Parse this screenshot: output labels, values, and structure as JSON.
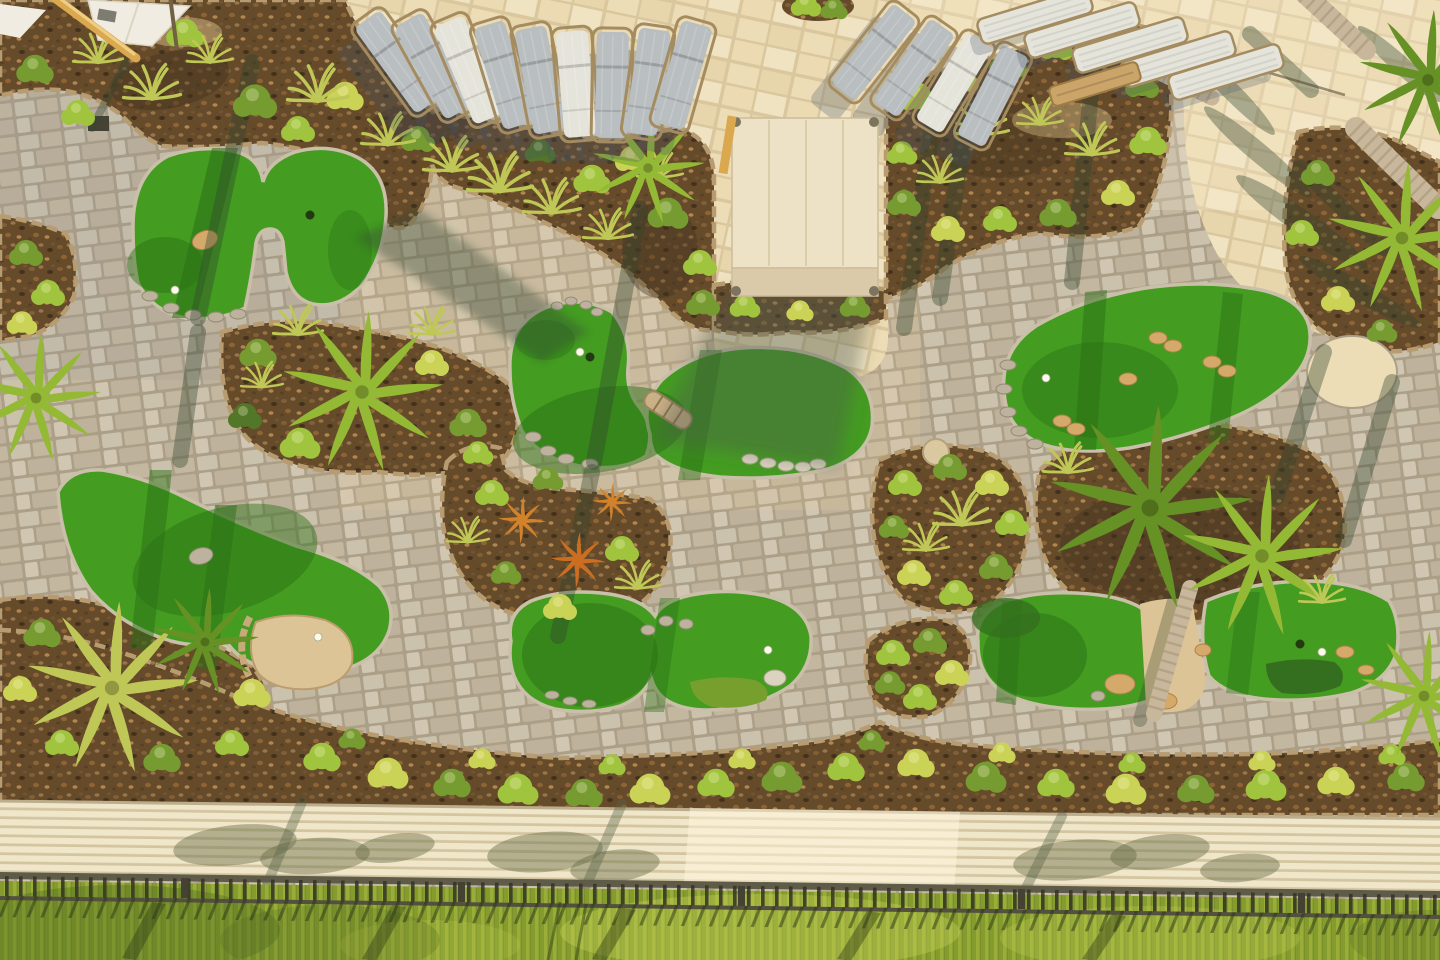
{
  "scene": {
    "type": "aerial-photograph",
    "subject": "Aerial view of an outdoor mini golf putting course with tropical landscaping at golden hour",
    "visible_text": "none"
  },
  "palette": {
    "green_sun": "#3a9a1e",
    "green_shade": "#1f6b12",
    "green_edge": "#c8c0ae",
    "fringe_dark": "#2a6b1c",
    "fringe_lime": "#6f9e2c",
    "paver_joint": "#a89d8a",
    "paver_a": "#c9c2b1",
    "paver_b": "#c1b7a4",
    "paver_c": "#cec7b7",
    "paver_d": "#bcb2a0",
    "deck_joint": "#d9c8a2",
    "deck_a": "#eddfbc",
    "deck_b": "#e6d6b0",
    "deck_c": "#ebddb7",
    "deck_d": "#f0e5c8",
    "mulch": "#5d4528",
    "bed_border": "#b59a72",
    "bush_a": "#9cc43d",
    "bush_b": "#6f9a2f",
    "bush_c": "#c9d457",
    "bush_dark": "#4a7325",
    "grass": "#bcc957",
    "frond_a": "#8fba33",
    "frond_b": "#5e8f22",
    "croton_a": "#d07f28",
    "croton_b": "#c96a1e",
    "trunk": "#c6b79e",
    "trunk_ring": "#a5957c",
    "lounger_sling": "#b6bec6",
    "lounger_light": "#e4e6e2",
    "lounger_frame": "#a08a60",
    "bench": "#c9a36a",
    "canopy": "#ece4cc",
    "canopy_fold": "#d8cbae",
    "canopy_seam": "#d9ceae",
    "pole": "#d9a84e",
    "sand": "#dbc49a",
    "rock_gray": "#b9b2a2",
    "rock_tan": "#d2a86a",
    "walk_a": "#f0e8d0",
    "walk_b": "#d2c6a5",
    "hedge_a": "#94ac36",
    "hedge_b": "#7d9a2b",
    "hedge_bright": "#ccd75a",
    "shadow": "rgba(40,62,45,0.38)"
  },
  "objects": {
    "putting_greens": [
      {
        "id": 1,
        "area": "upper-left",
        "features": "boulder obstacle, rock edging, golf ball"
      },
      {
        "id": 2,
        "area": "mid-left",
        "features": "stone block, sand patch, golf ball"
      },
      {
        "id": 3,
        "area": "center",
        "features": "log obstacle, rock clusters, golf ball and cup"
      },
      {
        "id": 4,
        "area": "mid-right",
        "features": "tan rock piles, rock edging, golf ball"
      },
      {
        "id": 5,
        "area": "lower-center",
        "features": "boulder, lime fringe patch, golf ball"
      },
      {
        "id": 6,
        "area": "lower-right",
        "features": "palm trunk through green, boulders, dark fringe, golf ball and cup"
      }
    ],
    "lounge_chairs": {
      "upper_center_fan_row": 9,
      "upper_right_diagonal_row": 4,
      "top_right_flat_row": 5,
      "wood_bench": 1
    },
    "cabana": {
      "position": "top center-right",
      "fabric": "cream canvas with seams and corner posts"
    },
    "umbrella": {
      "position": "top-left corner",
      "state": "white canopy with leaning tan pole"
    },
    "palm_trees": 10,
    "planting_beds": "mulched beds with shrubs, fountain grasses, crotons, palmettos",
    "bottom_strip": {
      "walkway": "cream plank pavers",
      "fence": "dark metal picket fence",
      "hedge": "trimmed hedge rows with long shadows"
    }
  }
}
